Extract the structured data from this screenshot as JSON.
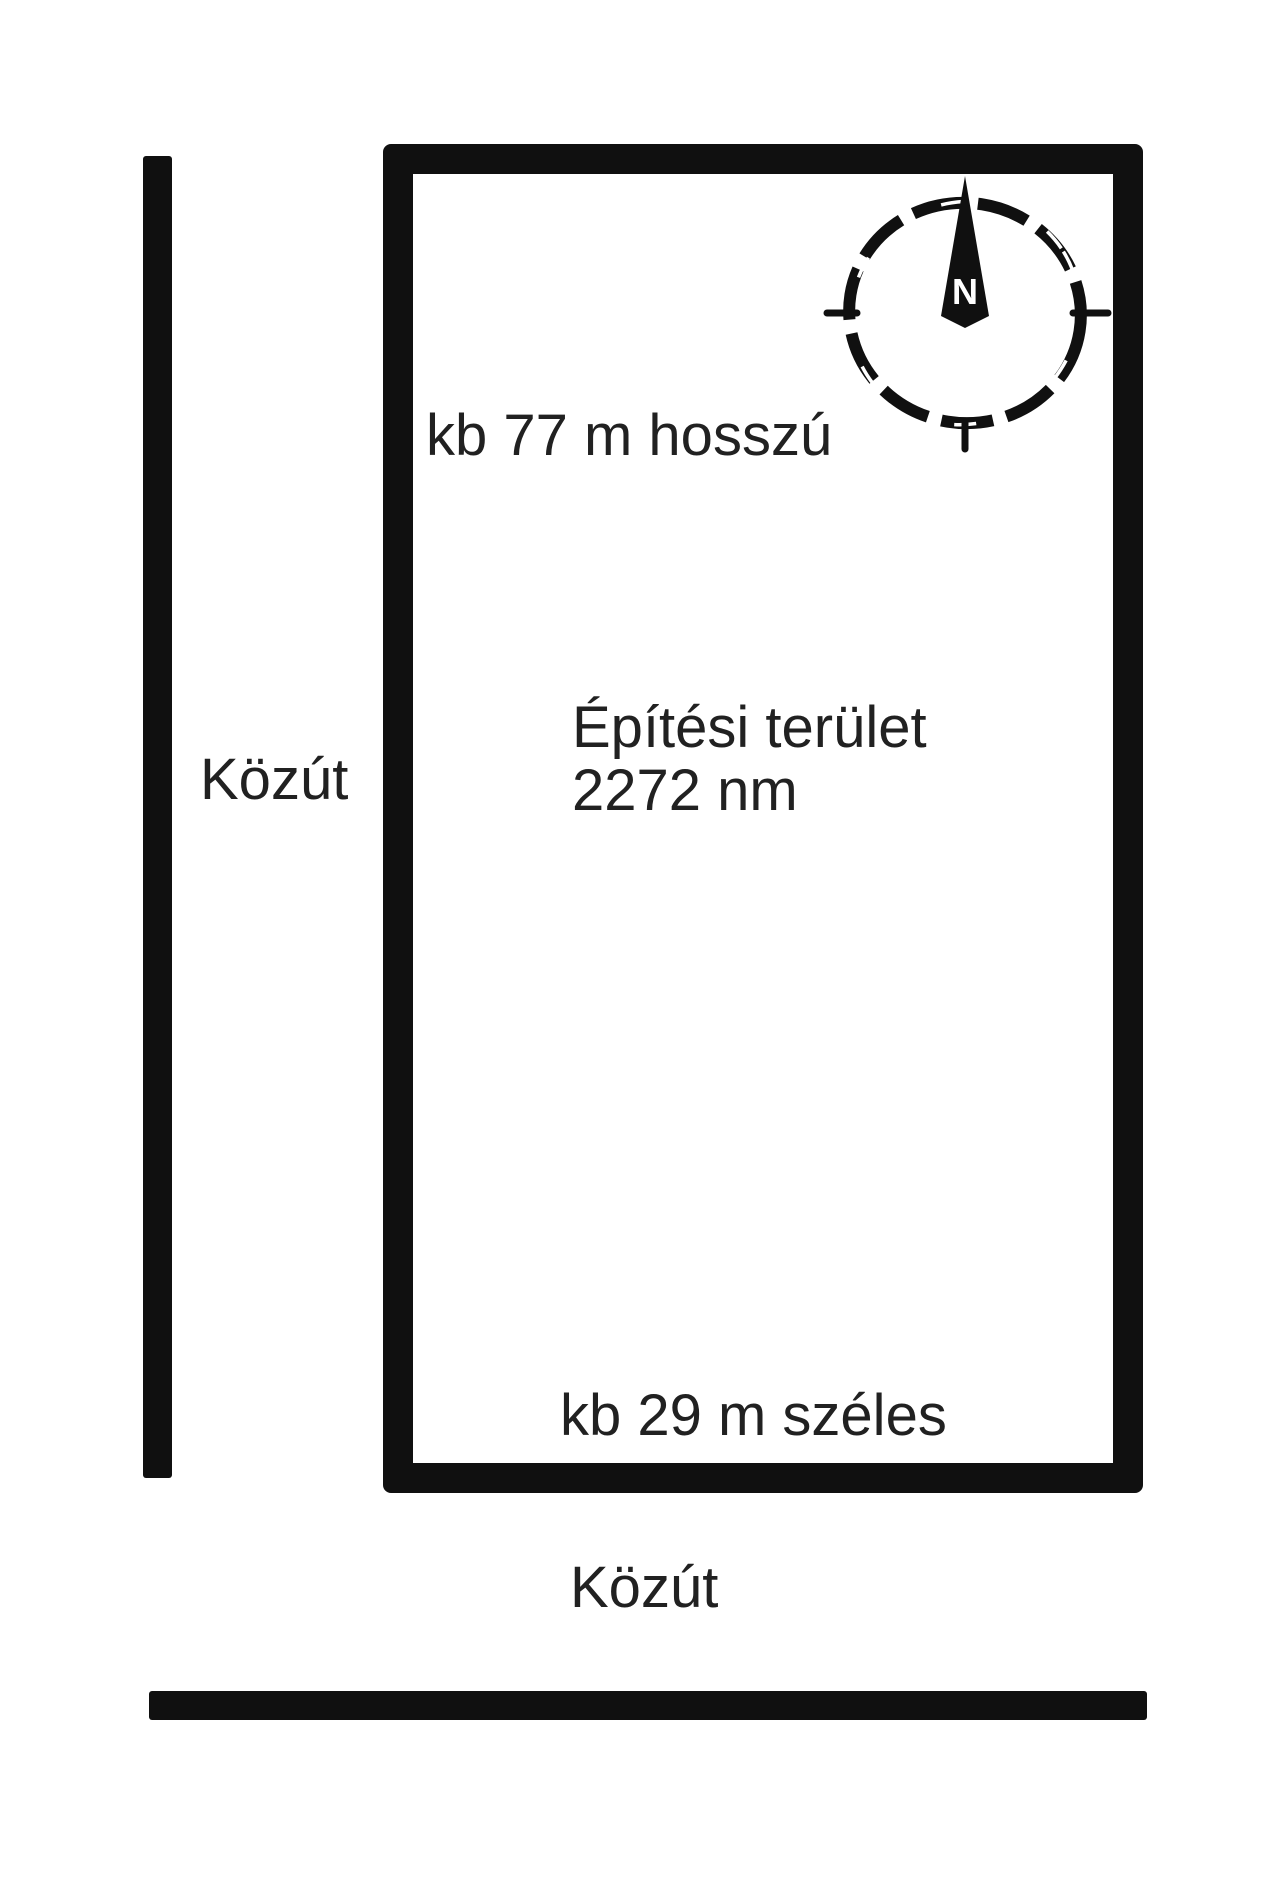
{
  "diagram": {
    "plot": {
      "length_label": "kb 77 m hosszú",
      "width_label": "kb 29 m széles",
      "area_title": "Építési terület",
      "area_value": "2272 nm"
    },
    "roads": {
      "left_label": "Közút",
      "bottom_label": "Közút"
    },
    "compass": {
      "north_label": "N"
    },
    "colors": {
      "line": "#101010",
      "text": "#212121",
      "background": "#ffffff"
    }
  }
}
